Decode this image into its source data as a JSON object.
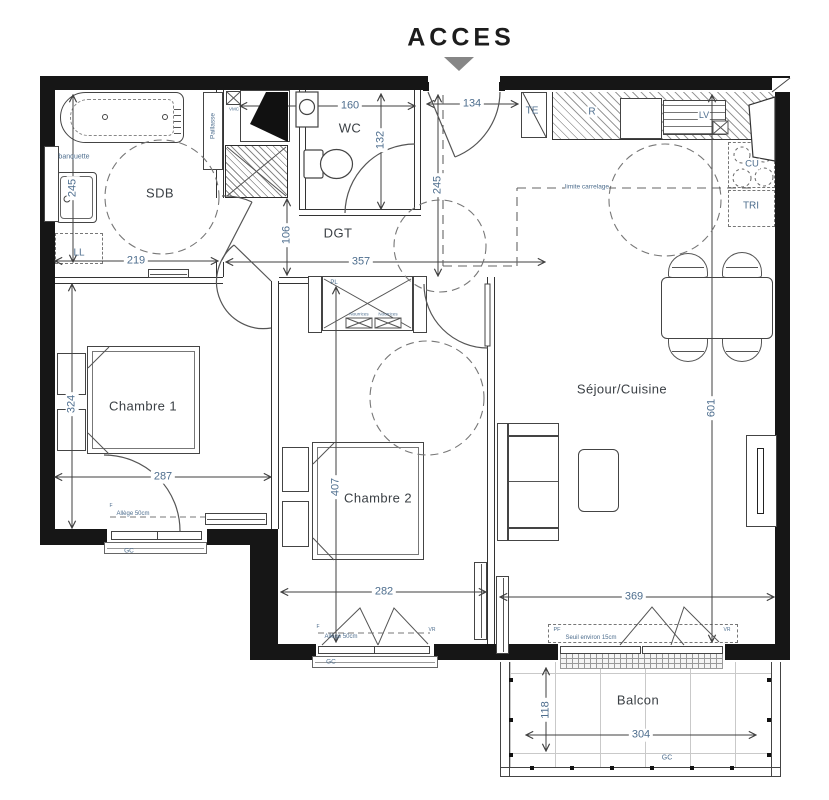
{
  "title": "ACCES",
  "rooms": {
    "sdb": "SDB",
    "wc": "WC",
    "dgt": "DGT",
    "chambre1": "Chambre 1",
    "chambre2": "Chambre 2",
    "sejour": "Séjour/Cuisine",
    "balcon": "Balcon"
  },
  "dims": {
    "sdb_w": "219",
    "sdb_d": "245",
    "wc_w": "160",
    "wc_d": "132",
    "entry_w": "134",
    "entry_d": "245",
    "dgt_l": "357",
    "dgt_w": "106",
    "c1_w": "287",
    "c1_d": "324",
    "c2_w": "282",
    "c2_d": "407",
    "sej_w": "369",
    "sej_d": "601",
    "bal_w": "304",
    "bal_d": "118"
  },
  "ann": {
    "banquette": "banquette",
    "paillasse": "Paillasse",
    "ll": "LL",
    "vmc": "VMC",
    "te": "TE",
    "r": "R",
    "lv": "LV",
    "cu": "CU",
    "tri": "TRI",
    "pl": "PL",
    "nourrices1": "Nourrices",
    "nourrices2": "Nourrices",
    "limite": "limite carrelage",
    "gc1": "GC",
    "gc2": "GC",
    "gc3": "GC",
    "f1": "F",
    "allege1": "Allège 50cm",
    "f2": "F",
    "allege2": "Allège 50cm",
    "vr1": "VR",
    "vr2": "VR",
    "pf": "PF",
    "seuil": "Seuil environ 15cm"
  },
  "colors": {
    "wall": "#161616",
    "dimension": "#4e6e8e",
    "room_label": "#3b4045",
    "arrow": "#868686"
  }
}
